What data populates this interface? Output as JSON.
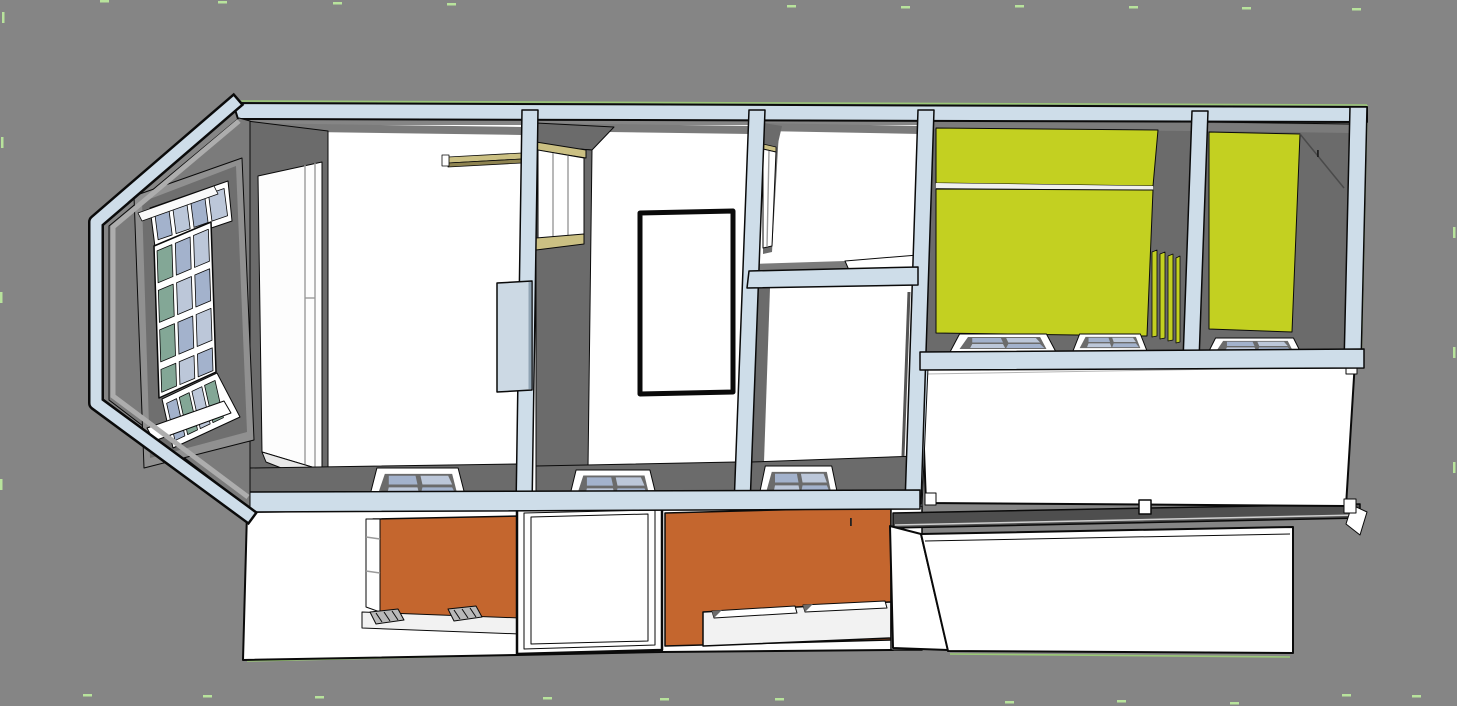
{
  "scene": {
    "kind": "3d-house-section-model",
    "view": "dollhouse cutaway seen from above and front",
    "visible_text": "",
    "levels": [
      {
        "name": "upper-floor-plan",
        "rooms": 6
      },
      {
        "name": "lower-facade",
        "rooms": 0
      }
    ]
  },
  "colors": {
    "background": "#858585",
    "wall_cut": "#cedde9",
    "wall_dark": "#6b6b6b",
    "wall_mid": "#7b7b7b",
    "frame_gray": "#909090",
    "frame_gray_dark": "#6f6f6f",
    "floor_white": "#ffffff",
    "opening_white": "#fdfdfd",
    "yellow": "#c3d021",
    "orange": "#c4662e",
    "khaki": "#cbc083",
    "khaki_dark": "#8e8350",
    "glass_blue": "#a3b2cc",
    "glass_blue_light": "#bcc7d9",
    "glass_green": "#83a796",
    "fascia": "#4e4e4e",
    "fireplace_blue": "#ccd9e4",
    "sill_white": "#f2f2f2",
    "seam_white": "#f0f0ee",
    "hatch_gray": "#b9b9b9",
    "edge_green": "#9dd076",
    "tick_green": "#b8e39c",
    "outline": "#0a0a0a"
  },
  "regions": [
    {
      "name": "bay-window",
      "fill": "wall_cut",
      "glass": [
        "glass_blue",
        "glass_green"
      ],
      "pane_grid": "3x4 plus angled sashes"
    },
    {
      "name": "living-room",
      "fill": "floor_white",
      "features": [
        "wood-beam",
        "fireplace-box",
        "floor-window"
      ]
    },
    {
      "name": "hall-room",
      "fill": "floor_white",
      "features": [
        "interior-window",
        "open-door-leaf",
        "floor-window"
      ]
    },
    {
      "name": "room-top-middle",
      "fill": "floor_white",
      "features": [
        "interior-window"
      ]
    },
    {
      "name": "room-bottom-middle",
      "fill": "floor_white",
      "features": [
        "floor-window"
      ]
    },
    {
      "name": "yellow-room-left",
      "fill": "yellow",
      "features": [
        "slatted-partition",
        "two-floor-windows"
      ]
    },
    {
      "name": "yellow-room-right",
      "fill": "yellow",
      "features": [
        "floor-window"
      ]
    },
    {
      "name": "flat-roof-wing",
      "fill": "floor_white",
      "features": [
        "corner-posts"
      ]
    },
    {
      "name": "facade-orange-left",
      "fill": "orange"
    },
    {
      "name": "facade-door-opening",
      "fill": "floor_white"
    },
    {
      "name": "facade-orange-right",
      "fill": "orange"
    },
    {
      "name": "lower-extension-box",
      "fill": "floor_white"
    }
  ],
  "marks": {
    "tick_color": "tick_green",
    "top_ticks_x": [
      100,
      218,
      333,
      447,
      787,
      901,
      1015,
      1129,
      1242,
      1352
    ],
    "bottom_ticks_x": [
      83,
      203,
      315,
      543,
      660,
      775,
      1005,
      1117,
      1230,
      1342,
      1412
    ],
    "left_ticks_y": [
      42,
      137,
      292,
      361,
      479,
      603
    ],
    "right_ticks_y": [
      227,
      347,
      462
    ]
  }
}
